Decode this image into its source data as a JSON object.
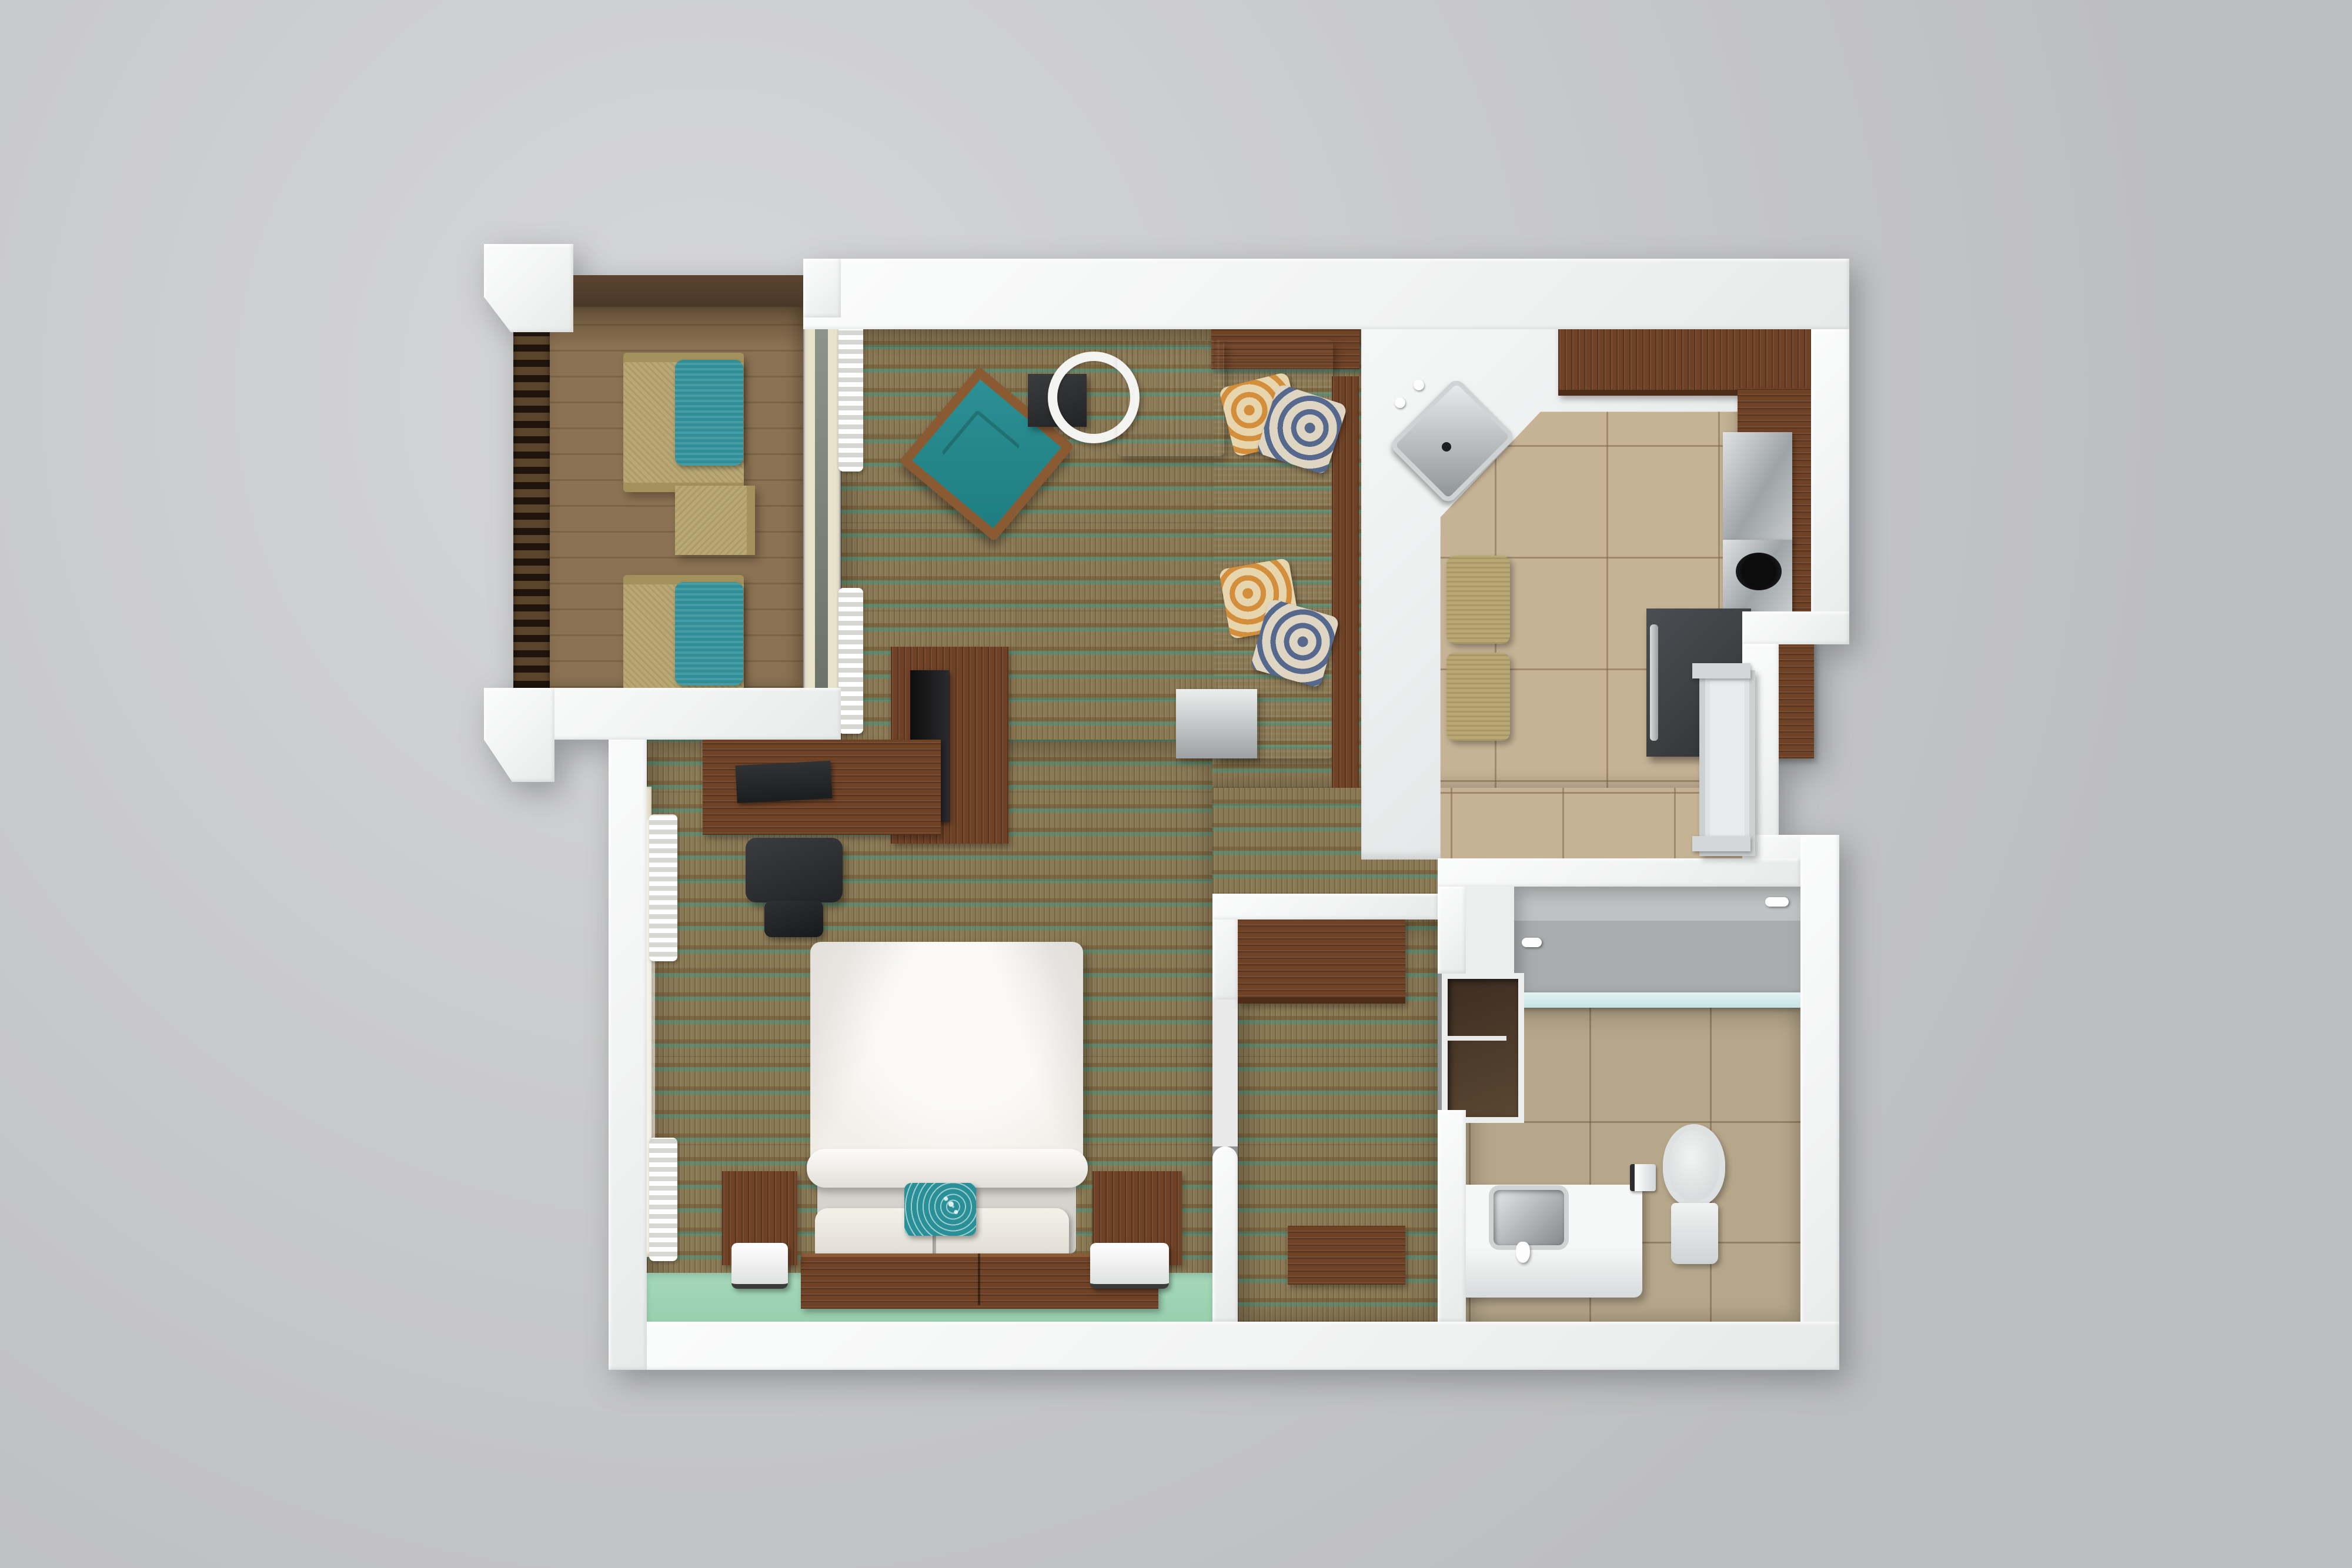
{
  "scene": {
    "kind": "3d-rendered floor plan, top-down view, hotel studio suite",
    "visible_text": "none",
    "label": "Studio suite 3D floor plan"
  },
  "palette": {
    "background": "#c8c9cb",
    "walls": "#f2f3f3",
    "carpet-base": "#8b7954",
    "carpet-teal": "#3f9784",
    "deck": "#8b7252",
    "railing": "#382a1a",
    "roof-edge": "#4a3828",
    "wood": "#6f4226",
    "teal-fabric": "#1f7d80",
    "teal-cushion": "#2f8e96",
    "tan-chair": "#b9a873",
    "tile-kitchen": "#c6b295",
    "tile-bath": "#b6a78b",
    "shower-gray": "#a9acad",
    "glass": "#c5e3e6",
    "green-floor": "#98cfad",
    "bed-white": "#f2efe9",
    "appliance-dark": "#3b3e41",
    "steel": "#b9bdbf",
    "orange-pillow": "#d79b4f",
    "blue-pillow": "#5d6f94",
    "accent-teal": "#2a9097"
  },
  "rooms": {
    "balcony": {
      "label": "Balcony",
      "furniture": [
        "lounge chair with teal cushion",
        "lounge chair with teal cushion",
        "woven side table"
      ],
      "floor": "wood deck with railing"
    },
    "living": {
      "label": "Living area",
      "furniture": [
        "teal sectional sofa",
        "teal lounge chair",
        "ring floor lamp",
        "brushed-metal cube table",
        "media console with TV",
        "work desk with laptop",
        "office chair"
      ],
      "floor": "patterned carpet"
    },
    "kitchen": {
      "label": "Kitchen",
      "furniture": [
        "white L counter with corner sink",
        "two bar stools",
        "upper cabinets",
        "cooktop",
        "oven-refrigerator unit",
        "entry door"
      ],
      "floor": "tan tile"
    },
    "bedroom": {
      "label": "Sleeping area",
      "furniture": [
        "platform bed with white duvet",
        "teal accent pillow",
        "two nightstands with lamps",
        "window with curtains"
      ],
      "floor": "patterned carpet with seafoam border"
    },
    "closet": {
      "label": "Closet / wardrobe",
      "furniture": [
        "dresser",
        "luggage bench",
        "glass shelf"
      ],
      "floor": "patterned carpet"
    },
    "bathroom": {
      "label": "Bathroom",
      "furniture": [
        "walk-in shower with glass screen",
        "storage niche",
        "vanity with sink",
        "toilet",
        "toilet-paper holder"
      ],
      "floor": "tan tile"
    }
  }
}
